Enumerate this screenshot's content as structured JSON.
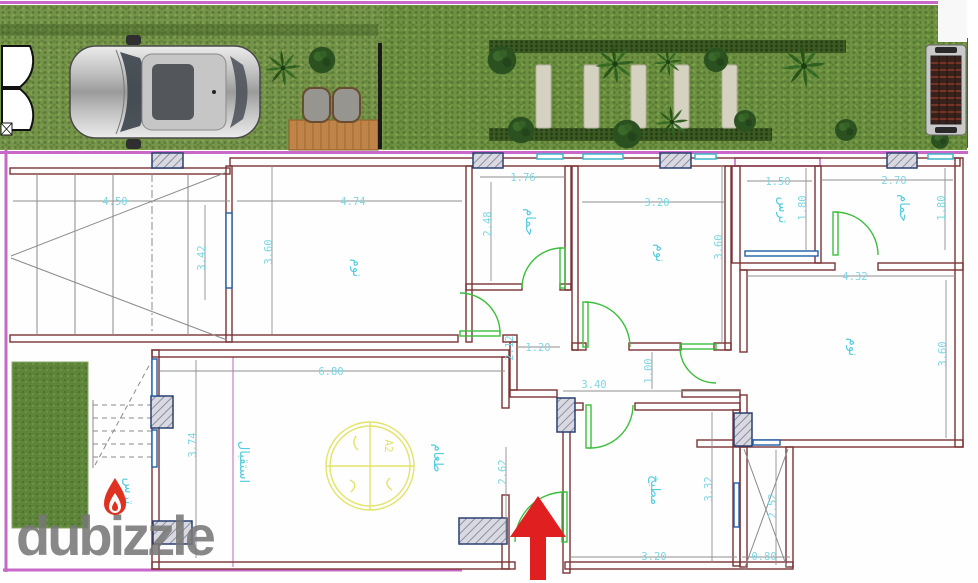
{
  "watermark": {
    "text": "dubizzle"
  },
  "site_plan": {
    "elements": [
      "entrance-gate",
      "car-top-view",
      "palm-tree",
      "garden-deck",
      "deck-chairs",
      "stepping-stones",
      "hedge",
      "bbq-grill",
      "lawn"
    ]
  },
  "floor_plan": {
    "colors": {
      "wall": "#7b3434",
      "outer_boundary": "#c868c8",
      "dimension_text": "#7fd6e2",
      "door": "#3cbf3c",
      "window_blue": "#1f5fa8",
      "window_cyan": "#3fb3c9",
      "column_border": "#2a3f70",
      "stamp": "#e3e36a",
      "entrance_arrow": "#e02020"
    },
    "stamp": {
      "label": "A2"
    },
    "rooms": [
      {
        "name": "bedroom-1",
        "label": "نوم",
        "dim_w": "4.74",
        "dim_h": "3.60"
      },
      {
        "name": "bathroom-1",
        "label": "حمام",
        "dim_w": "1.76",
        "dim_h": "2.48"
      },
      {
        "name": "bedroom-2",
        "label": "نوم",
        "dim_w": "3.20",
        "dim_h": "3.60"
      },
      {
        "name": "terrace-top",
        "label": "ترس",
        "dim_w": "1.50",
        "dim_h": "1.80"
      },
      {
        "name": "bathroom-2",
        "label": "حمام",
        "dim_w": "2.70",
        "dim_h": "1.80"
      },
      {
        "name": "bedroom-3",
        "label": "نوم",
        "dim_w": "4.32",
        "dim_h": "3.60"
      },
      {
        "name": "reception",
        "label": "استقبال",
        "dim_w": "6.80",
        "dim_h": "3.74"
      },
      {
        "name": "dining",
        "label": "طعام",
        "dim_h": "2.62"
      },
      {
        "name": "kitchen",
        "label": "مطبخ",
        "dim_w": "3.20",
        "dim_h": "3.32"
      },
      {
        "name": "terrace-bottom",
        "label": "ترس"
      },
      {
        "name": "shaft",
        "dim_w": "0.80",
        "dim_h": "2.52"
      },
      {
        "name": "garage-ramp",
        "dim_w": "4.50",
        "dim_h": "3.42"
      },
      {
        "name": "hall",
        "dim_w": "1.20",
        "dim_h": "2.12"
      },
      {
        "name": "corridor",
        "dim_w": "3.40",
        "dim_h": "1.00"
      }
    ]
  }
}
